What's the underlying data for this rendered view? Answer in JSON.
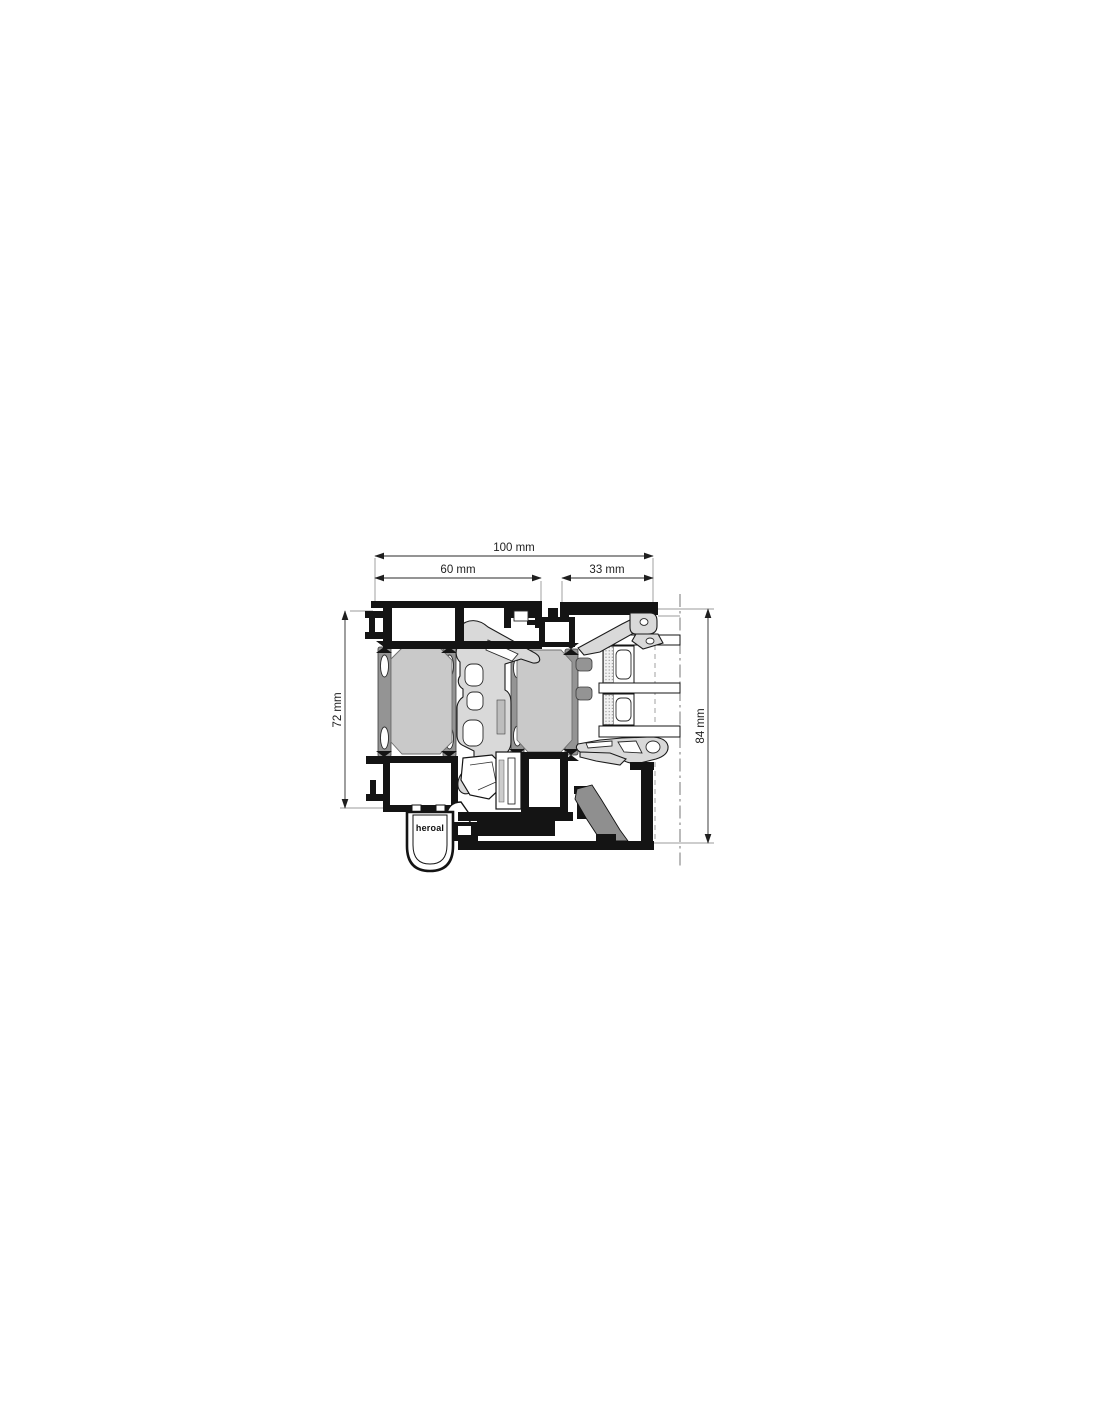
{
  "diagram": {
    "type": "technical-cross-section",
    "dimensions": {
      "total_width": "100 mm",
      "frame_width": "60 mm",
      "sash_width": "33 mm",
      "frame_height": "72 mm",
      "system_height": "84 mm"
    },
    "brand_label": "heroal",
    "colors": {
      "line": "#141414",
      "insulation": "#c9c9c9",
      "polyamide": "#d9d9d9",
      "strut": "#949494",
      "gasket": "#8f8f8f"
    }
  }
}
